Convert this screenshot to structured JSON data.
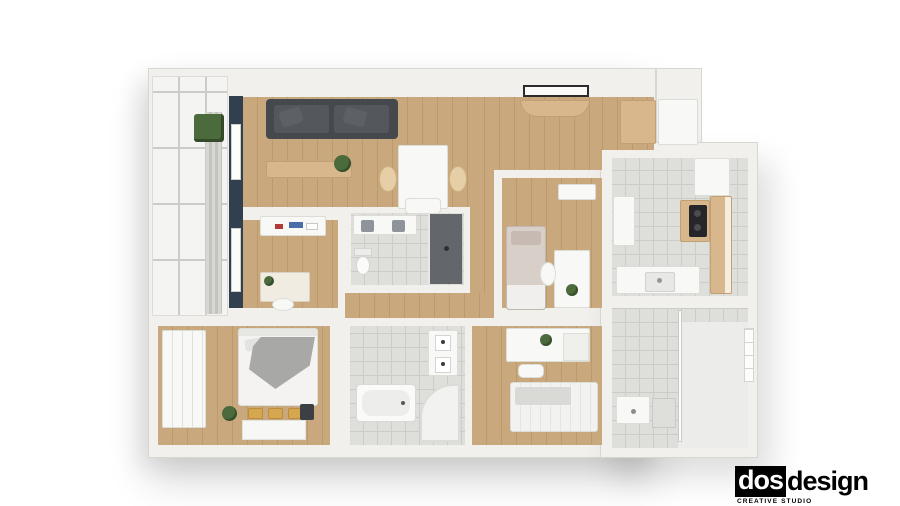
{
  "logo": {
    "part_boxed": "dos",
    "part_plain": "design",
    "tagline": "CREATIVE STUDIO"
  },
  "theme": {
    "page-bg": "#ffffff",
    "wall": "#f1f0ed",
    "wall-edge": "#d8d6d1",
    "wood": "#c8a87c",
    "wood-line": "#bb9a6c",
    "wood-furn": "#d7b78b",
    "tile": "#dedfdb",
    "tile-line": "#cbccc7",
    "navy": "#30404e",
    "sofa": "#45484d",
    "sofa-cushion": "#54575c",
    "white-furn": "#f8f8f6",
    "shower-dark": "#63676b",
    "green": "#4c6b3c",
    "basket": "#d7a750",
    "textile-gray": "#a8a8a6",
    "logo-ink": "#000000"
  }
}
